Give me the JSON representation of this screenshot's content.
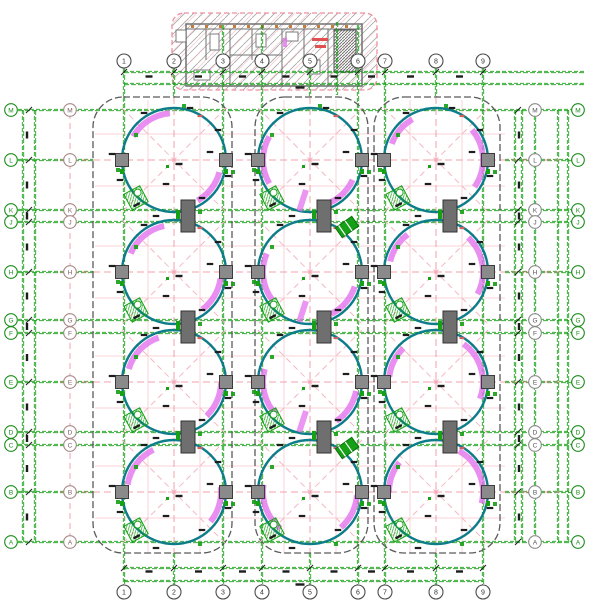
{
  "drawing": {
    "title": "Tank farm layout plan – 12 circular tanks with auxiliary building",
    "canvas": {
      "w": 600,
      "h": 600,
      "background": "#ffffff"
    },
    "colors": {
      "grid_green": "#18a018",
      "centerline_pink": "#f2a0ac",
      "diag_pink": "#f4b8c4",
      "tank_teal": "#0d7d8a",
      "scraper_magenta": "#e473ee",
      "enclosure_gray": "#5a5a5a",
      "pad_fill": "#8a8a8a",
      "pad_stroke": "#3c3c3c",
      "wall_gray": "#707070",
      "hatch_gray": "#a6a6a6",
      "hatch_pink": "#f0b4be",
      "border_pink": "#ee90a0",
      "symbol_green": "#15a015",
      "dim_black": "#1d1d1d",
      "accent_red": "#e05050",
      "accent_orange": "#c77d3a",
      "bubble_number": "#4a4a4a",
      "bubble_number_text": "#333333",
      "bubble_letter_outer": "#1a8c1a",
      "bubble_letter_inner_left": "#a88888",
      "bubble_letter_inner_left_text": "#7a6060",
      "bubble_letter_inner_right": "#8a8a8a",
      "bubble_letter_inner_right_text": "#555555"
    },
    "column_axes": {
      "labels": [
        "1",
        "2",
        "3",
        "4",
        "5",
        "6",
        "7",
        "8",
        "9"
      ],
      "x": [
        124,
        174,
        223,
        262,
        310,
        358,
        385,
        436,
        483
      ],
      "tank_center_indices": [
        1,
        4,
        7
      ],
      "bubble_y_top": 61,
      "bubble_y_bottom": 592
    },
    "row_axes": {
      "labels": [
        "M",
        "L",
        "K",
        "J",
        "H",
        "G",
        "F",
        "E",
        "D",
        "C",
        "B",
        "A"
      ],
      "y": [
        110,
        160,
        210,
        222,
        272,
        320,
        333,
        382,
        432,
        445,
        492,
        542
      ],
      "tank_center_indices": [
        1,
        4,
        7,
        10
      ],
      "bubble_x_left": [
        11,
        70
      ],
      "bubble_x_right": [
        535,
        578
      ]
    },
    "tanks": {
      "cx": [
        174,
        310,
        436
      ],
      "cy": [
        160,
        272,
        382,
        492
      ],
      "radius": 52,
      "scraper_arcs_by_column": [
        [
          [
            95,
            150
          ],
          [
            300,
            345
          ]
        ],
        [
          [
            150,
            210
          ],
          [
            290,
            335
          ]
        ],
        [
          [
            -35,
            40
          ],
          [
            120,
            160
          ]
        ]
      ]
    },
    "enclosures": [
      {
        "x1": 93,
        "x2": 232
      },
      {
        "x1": 255,
        "x2": 368
      },
      {
        "x1": 374,
        "x2": 500
      }
    ],
    "enclosure_y": {
      "y1": 97,
      "y2": 553,
      "rx": 30
    },
    "building": {
      "x": 172,
      "y": 13,
      "w": 205,
      "h": 77,
      "body": {
        "x": 186,
        "y": 24,
        "w": 176,
        "h": 62
      }
    },
    "dims": {
      "top_lines_y": [
        72,
        84
      ],
      "bottom_lines_y": [
        568,
        581
      ],
      "left_cols_x": [
        23,
        35
      ],
      "right_cols_x": [
        515,
        522,
        535,
        558,
        568
      ]
    }
  }
}
